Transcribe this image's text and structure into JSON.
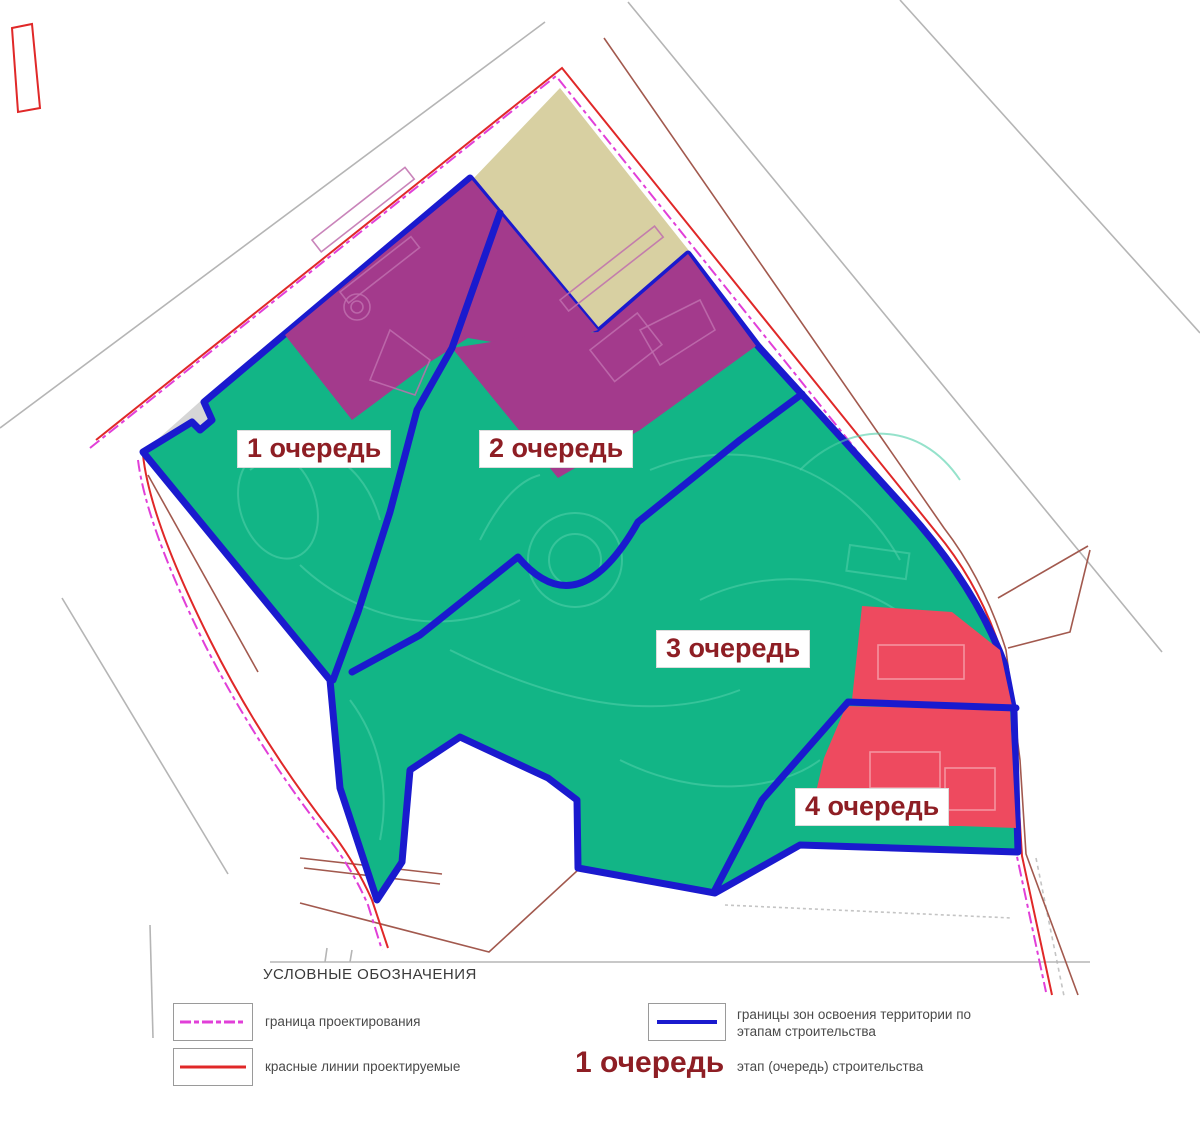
{
  "map": {
    "zones": [
      {
        "id": "1",
        "label": "1 очередь"
      },
      {
        "id": "2",
        "label": "2 очередь"
      },
      {
        "id": "3",
        "label": "3 очередь"
      },
      {
        "id": "4",
        "label": "4 очередь"
      }
    ]
  },
  "legend": {
    "title": "УСЛОВНЫЕ ОБОЗНАЧЕНИЯ",
    "design_boundary_label": "граница проектирования",
    "red_lines_label": "красные линии проектируемые",
    "stage_zones_label_line1": "границы зон освоения территории по",
    "stage_zones_label_line2": "этапам строительства",
    "stage_sample_label": "1 очередь",
    "stage_meaning_label": "этап (очередь) строительства"
  },
  "colors": {
    "zone_green": "#12b586",
    "zone_purple": "#a33a8c",
    "zone_red": "#ee4a5f",
    "excluded_beige": "#d8d0a2",
    "stage_boundary_blue": "#1a1ace",
    "design_boundary_magenta": "#e13fd8",
    "red_line": "#e02828",
    "road_gray": "#b5b5b5",
    "road_brown": "#a2594e",
    "label_maroon": "#8e1e24",
    "path_light_green": "#4ecfa8",
    "detail_light_purple": "#c06fae",
    "detail_light_red": "#f59aa6"
  }
}
